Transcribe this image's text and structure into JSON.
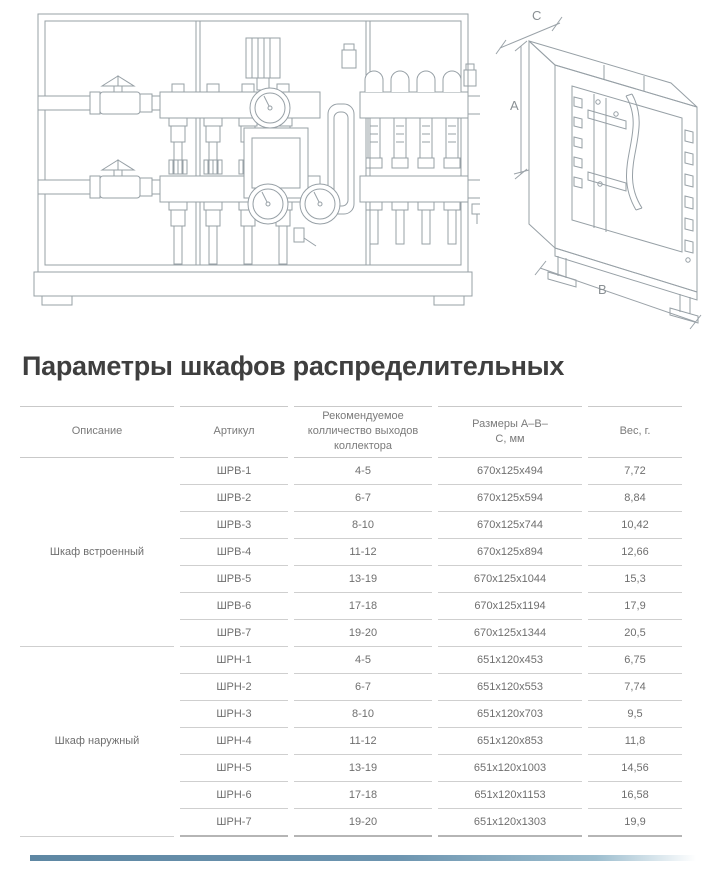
{
  "title": "Параметры шкафов распределительных",
  "diagram": {
    "dim_a": "A",
    "dim_b": "B",
    "dim_c": "C"
  },
  "table": {
    "headers": {
      "description": "Описание",
      "article": "Артикул",
      "outputs": "Рекомендуемое колличество выходов коллектора",
      "dimensions": "Размеры А–В–С, мм",
      "weight": "Вес, г."
    },
    "groups": [
      {
        "description": "Шкаф встроенный",
        "rows": [
          {
            "article": "ШРВ-1",
            "outputs": "4-5",
            "dimensions": "670x125x494",
            "weight": "7,72"
          },
          {
            "article": "ШРВ-2",
            "outputs": "6-7",
            "dimensions": "670x125x594",
            "weight": "8,84"
          },
          {
            "article": "ШРВ-3",
            "outputs": "8-10",
            "dimensions": "670x125x744",
            "weight": "10,42"
          },
          {
            "article": "ШРВ-4",
            "outputs": "11-12",
            "dimensions": "670x125x894",
            "weight": "12,66"
          },
          {
            "article": "ШРВ-5",
            "outputs": "13-19",
            "dimensions": "670x125x1044",
            "weight": "15,3"
          },
          {
            "article": "ШРВ-6",
            "outputs": "17-18",
            "dimensions": "670x125x1194",
            "weight": "17,9"
          },
          {
            "article": "ШРВ-7",
            "outputs": "19-20",
            "dimensions": "670x125x1344",
            "weight": "20,5"
          }
        ]
      },
      {
        "description": "Шкаф наружный",
        "rows": [
          {
            "article": "ШРН-1",
            "outputs": "4-5",
            "dimensions": "651x120x453",
            "weight": "6,75"
          },
          {
            "article": "ШРН-2",
            "outputs": "6-7",
            "dimensions": "651x120x553",
            "weight": "7,74"
          },
          {
            "article": "ШРН-3",
            "outputs": "8-10",
            "dimensions": "651x120x703",
            "weight": "9,5"
          },
          {
            "article": "ШРН-4",
            "outputs": "11-12",
            "dimensions": "651x120x853",
            "weight": "11,8"
          },
          {
            "article": "ШРН-5",
            "outputs": "13-19",
            "dimensions": "651x120x1003",
            "weight": "14,56"
          },
          {
            "article": "ШРН-6",
            "outputs": "17-18",
            "dimensions": "651x120x1153",
            "weight": "16,58"
          },
          {
            "article": "ШРН-7",
            "outputs": "19-20",
            "dimensions": "651x120x1303",
            "weight": "19,9"
          }
        ]
      }
    ]
  },
  "footer": {
    "accent_color": "#5e87a3"
  }
}
